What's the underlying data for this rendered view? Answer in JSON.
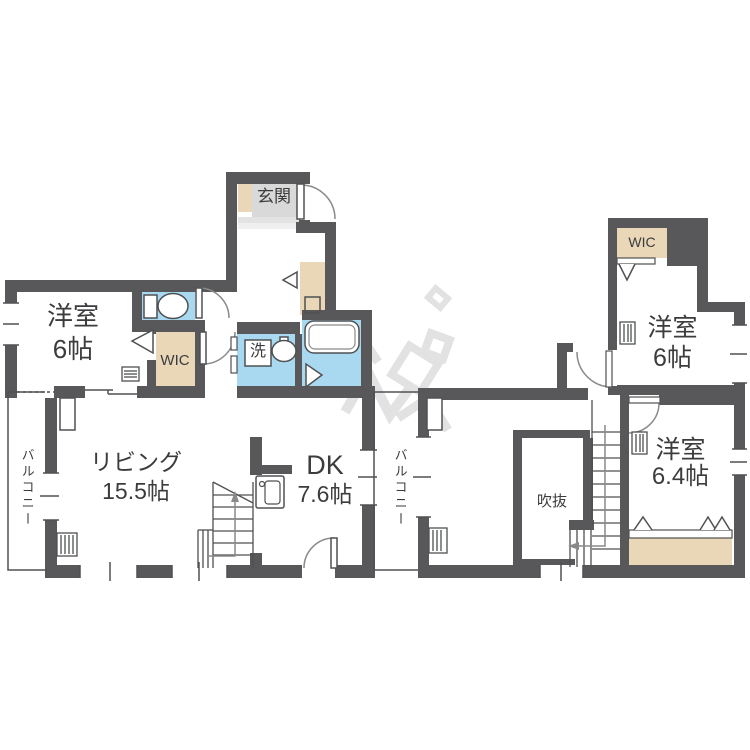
{
  "palette": {
    "wall": "#58585a",
    "wet_area": "#a9d9f1",
    "closet": "#e9d7b8",
    "entry_floor": "#d9d9d9",
    "thin_line": "#4f5052",
    "arc_line": "#8a8a8a",
    "text": "#3c3c3e",
    "watermark": "#e2e2e2"
  },
  "floor1": {
    "entrance": "玄関",
    "bedroom_name": "洋室",
    "bedroom_size": "6帖",
    "wic": "WIC",
    "wash": "洗",
    "living_name": "リビング",
    "living_size": "15.5帖",
    "dk_name": "DK",
    "dk_size": "7.6帖",
    "balcony": "バルコニー"
  },
  "floor2": {
    "wic": "WIC",
    "bedroom1_name": "洋室",
    "bedroom1_size": "6帖",
    "bedroom2_name": "洋室",
    "bedroom2_size": "6.4帖",
    "void": "吹抜",
    "balcony": "バルコニー"
  }
}
